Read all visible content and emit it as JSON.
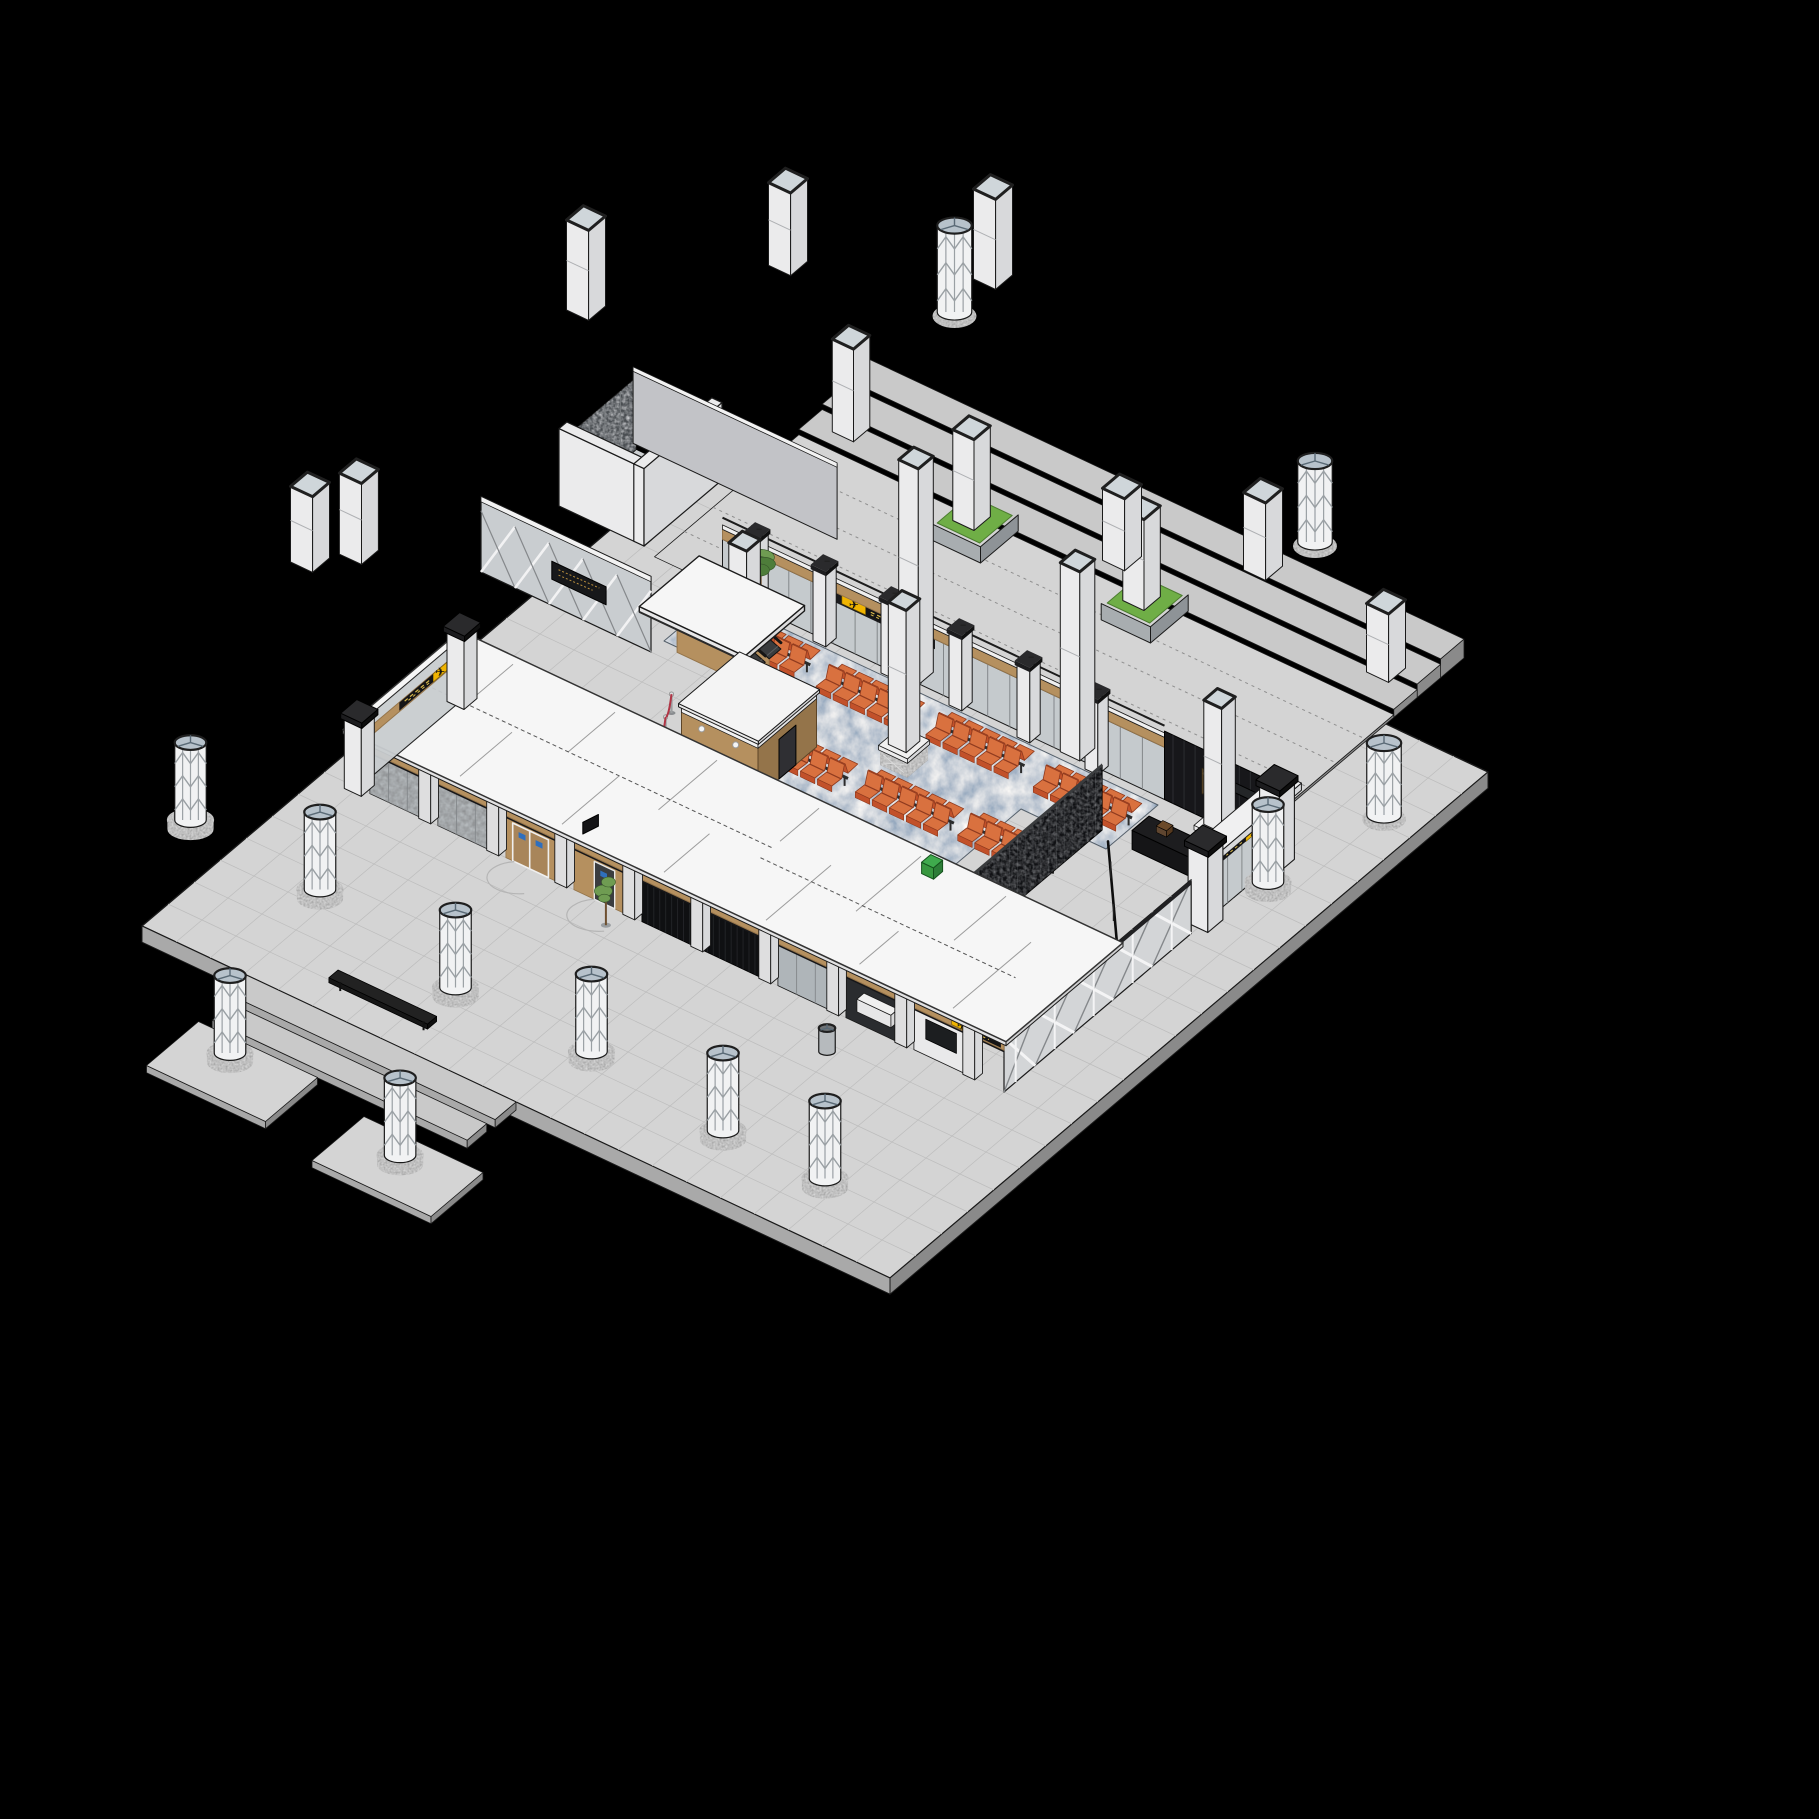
{
  "meta": {
    "description": "Isometric 3D cutaway rendering of a transit-station entrance hall model floating on a black background",
    "background": "#000000",
    "view": "axonometric section cutaway"
  },
  "palette": {
    "bg": "#000000",
    "plazaTop": "#d4d4d4",
    "plazaLine": "#bdbdbd",
    "plazaSideL": "#a9a9a9",
    "plazaSideR": "#8a8a8a",
    "stepTop": "#c9c9c9",
    "roofWhite": "#f6f6f6",
    "roofEdge": "#e7e7e8",
    "fasciaWhite": "#efefef",
    "roofLine": "#9c9c9c",
    "wallWhite": "#ebebec",
    "wallMid": "#d8d9db",
    "wallShadow": "#c2c3c7",
    "glass": "#c5cacd",
    "glassDark": "#afb5b9",
    "mullion": "#83878a",
    "wood": "#b5905f",
    "woodDark": "#94744a",
    "woodDoor": "#a8855a",
    "darkPanel": "#141416",
    "darkScreen": "#0f1012",
    "darkBand": "#1b1b1d",
    "granite": "#6f6f6f",
    "cylBody": "#f1f2f3",
    "cylTop": "#b7c2cb",
    "latLine": "#9aa0a4",
    "colTop": "#cfd6da",
    "colRim": "#1f1f1f",
    "seat": "#c2512a",
    "seatLight": "#d9713f",
    "seatDark": "#8f3a1e",
    "seatFrame": "#2b2b2b",
    "grass": "#6fae46",
    "planter": "#8e9397",
    "signYellow": "#f0b400",
    "plaqueBlue": "#2f6fbd",
    "doorBlue": "#2742c8",
    "artGold": "#8a6b40",
    "artGoldLight": "#c8a96b",
    "rope": "#b03545",
    "pole": "#9b9ea0",
    "counterTop": "#1d1d1f",
    "counterSide": "#0c0c0d",
    "plantGreen": "#4e7d3a",
    "plantLight": "#6f9c52",
    "trunk": "#6d4f2f",
    "accentGreen": "#3faa4d",
    "accentYellow": "#cdd52e",
    "outline": "#1a1a1a"
  },
  "signage": {
    "airplane_glyph": "✈",
    "wayfinding_color": "#f0b400",
    "locations": [
      "waiting-hall-back-wall",
      "south-facade-right",
      "east-entrance",
      "west-corner-entrance"
    ],
    "door_plaque_color": "#2f6fbd"
  },
  "waiting_area": {
    "carpet_style": "mottled blue-gray",
    "seat_clusters": [
      [
        9,
        11.8
      ],
      [
        15.3,
        12.0
      ],
      [
        21.6,
        11.8
      ],
      [
        28,
        11.9
      ],
      [
        15.5,
        17.4
      ],
      [
        21.5,
        17.1
      ],
      [
        27.3,
        16.8
      ]
    ],
    "rows_per_cluster": 2,
    "seats_per_row": 5
  },
  "columns": {
    "standing_lattice": [
      [
        -2.5,
        39
      ],
      [
        5.5,
        39.5
      ],
      [
        15,
        41.5
      ],
      [
        23,
        41.5
      ],
      [
        31.5,
        42.5
      ],
      [
        37.5,
        42.5
      ],
      [
        9,
        51
      ],
      [
        20,
        52.3
      ],
      [
        41,
        13
      ]
    ],
    "floating_lattice": [
      [
        6.5,
        -8,
        4,
        8.8
      ],
      [
        30,
        -5,
        3.5,
        8
      ],
      [
        44,
        8,
        2.5,
        6.5
      ]
    ],
    "floating_square": [
      [
        -6,
        4,
        6,
        11
      ],
      [
        -1,
        -5,
        5.2,
        9.8
      ],
      [
        8,
        -9,
        6,
        11
      ],
      [
        24,
        2,
        4.2,
        8.2
      ],
      [
        30,
        -1,
        4.5,
        8.8
      ],
      [
        38,
        0,
        3,
        6.8
      ],
      [
        -10,
        20,
        0,
        4.2
      ],
      [
        -8.5,
        18.2,
        0,
        4.5
      ]
    ],
    "interior_cut": [
      [
        12.5,
        16,
        8.6
      ],
      [
        21.5,
        15.5,
        9
      ],
      [
        37,
        11.5,
        8
      ],
      [
        18,
        10,
        12
      ],
      [
        27.5,
        10,
        10.5
      ]
    ],
    "back_wall_piers": [
      9,
      13,
      17,
      21,
      25,
      29
    ]
  },
  "queue": {
    "stanchions": [
      [
        10.5,
        19
      ],
      [
        11.3,
        20.5
      ],
      [
        12.1,
        22
      ]
    ]
  },
  "terrace": {
    "planters": [
      [
        14,
        0.5
      ],
      [
        24,
        0.5
      ]
    ],
    "bare_column": [
      5,
      -2
    ]
  },
  "escalators": {
    "count": 2,
    "lanes_v": [
      13.2,
      14.4
    ]
  },
  "fixtures": {
    "benches": 1,
    "trash_bins": 1,
    "plants": 2,
    "security_scanner": 1,
    "reception_counter": 1,
    "artwork_panels": 1,
    "blue_framed_doors": 1
  }
}
